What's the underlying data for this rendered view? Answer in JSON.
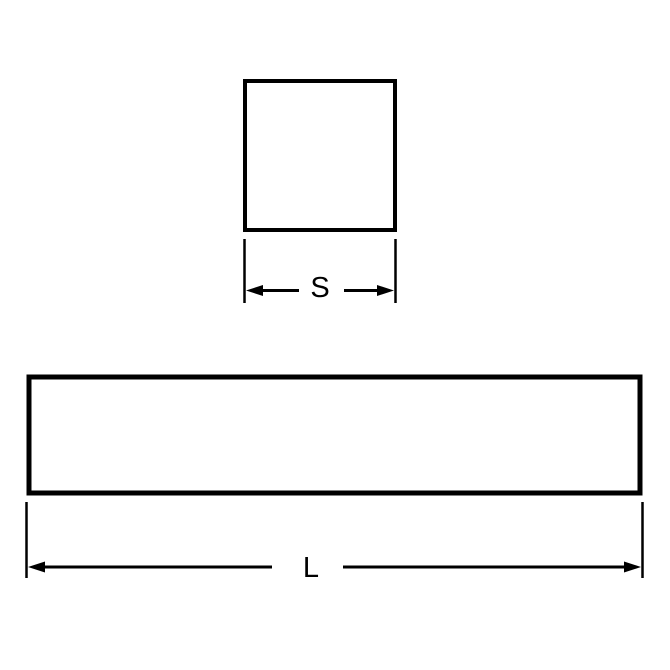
{
  "colors": {
    "line": "#000000",
    "background": "#ffffff"
  },
  "drawing": {
    "square_view": {
      "shape": "square",
      "side_dimension": {
        "label": "S"
      }
    },
    "bar_view": {
      "shape": "rectangle",
      "length_dimension": {
        "label": "L"
      }
    }
  }
}
